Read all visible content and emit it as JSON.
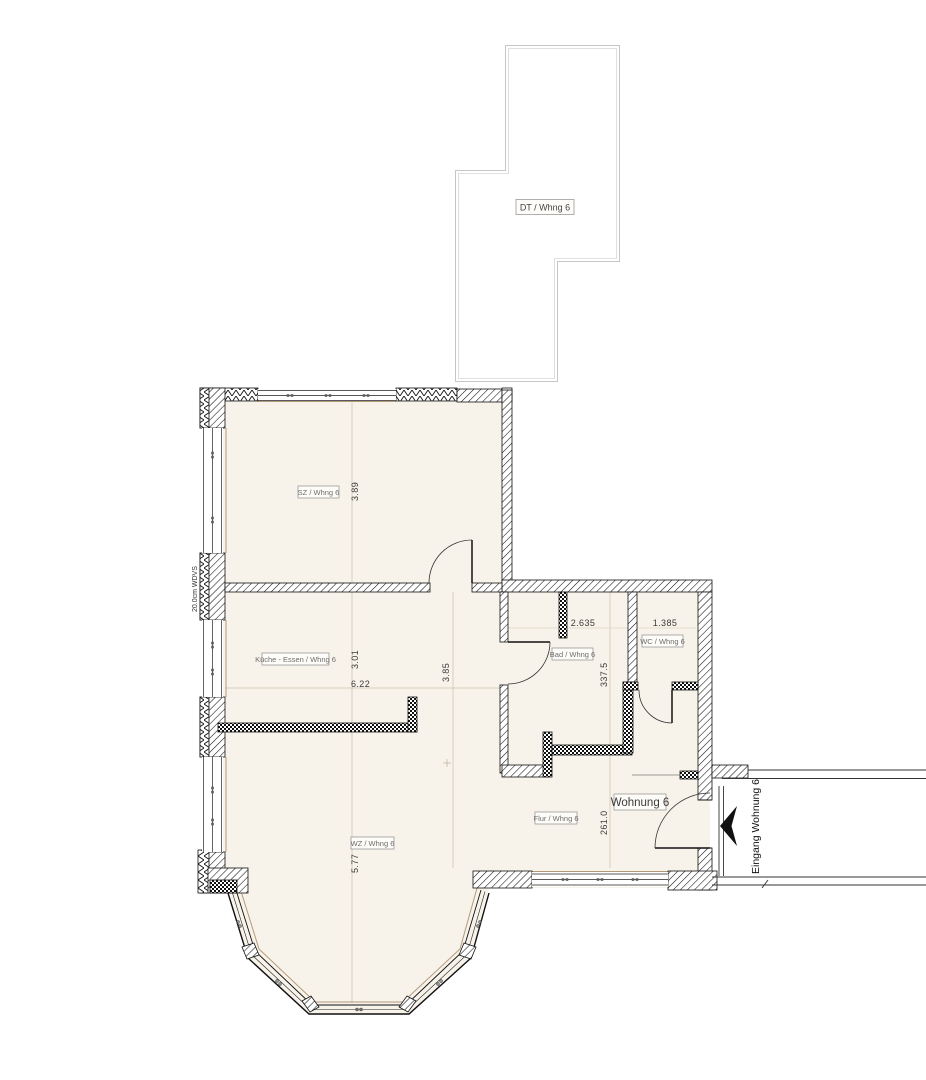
{
  "plan": {
    "unit_label": "Wohnung 6",
    "terrace_label": "DT / Whng 6",
    "entrance_label": "Eingang Wohnung 6",
    "insulation_label": "20.0cm WDVS",
    "rooms": [
      {
        "id": "sz",
        "label": "SZ / Whng 6"
      },
      {
        "id": "kueche",
        "label": "Küche - Essen / Whng 6"
      },
      {
        "id": "wz",
        "label": "WZ / Whng 6"
      },
      {
        "id": "bad",
        "label": "Bad / Whng 6"
      },
      {
        "id": "wc",
        "label": "WC / Whng 6"
      },
      {
        "id": "flur",
        "label": "Flur / Whng 6"
      }
    ],
    "dimensions": {
      "sz_width": "3.89",
      "kueche_depth": "3.01",
      "kueche_width": "6.22",
      "kueche_inner": "3.85",
      "wz_width": "5.77",
      "bad_width": "2.635",
      "wc_width": "1.385",
      "bad_height_cm": "337.5",
      "flur_height_cm": "261.0"
    },
    "colors": {
      "room_fill": "#f8f3ea",
      "wall_line": "#111111",
      "terrace_outline": "#c8c8c8",
      "guide_line": "#cfc3ad",
      "sill_line": "#b59a7a"
    }
  }
}
